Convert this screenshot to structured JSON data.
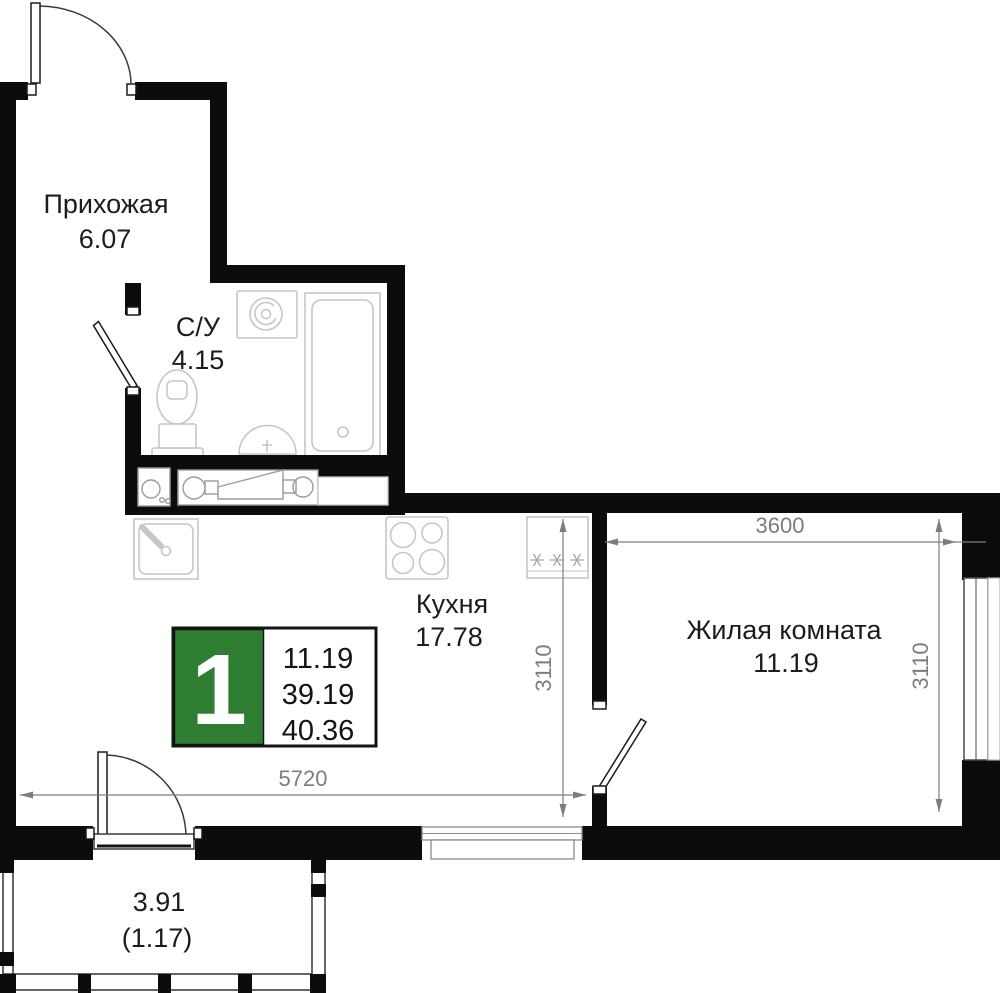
{
  "rooms": {
    "hallway": {
      "label": "Прихожая",
      "area": "6.07"
    },
    "bathroom": {
      "label": "С/У",
      "area": "4.15"
    },
    "kitchen": {
      "label": "Кухня",
      "area": "17.78"
    },
    "living_room": {
      "label": "Жилая комната",
      "area": "11.19"
    },
    "balcony": {
      "area": "3.91",
      "area_with_coefficient": "(1.17)"
    }
  },
  "info_badge": {
    "room_count": "1",
    "living_area": "11.19",
    "area_without_balcony": "39.19",
    "total_area": "40.36",
    "accent_color": "#2e7d32"
  },
  "dimensions": {
    "overall_width": "5720",
    "kitchen_depth": "3110",
    "living_room_width": "3600",
    "living_room_depth": "3110"
  },
  "colors": {
    "wall": "#0c0c0c",
    "dimension_lines": "#7d7d7d",
    "fixture_outlines": "#c6c6c6"
  }
}
